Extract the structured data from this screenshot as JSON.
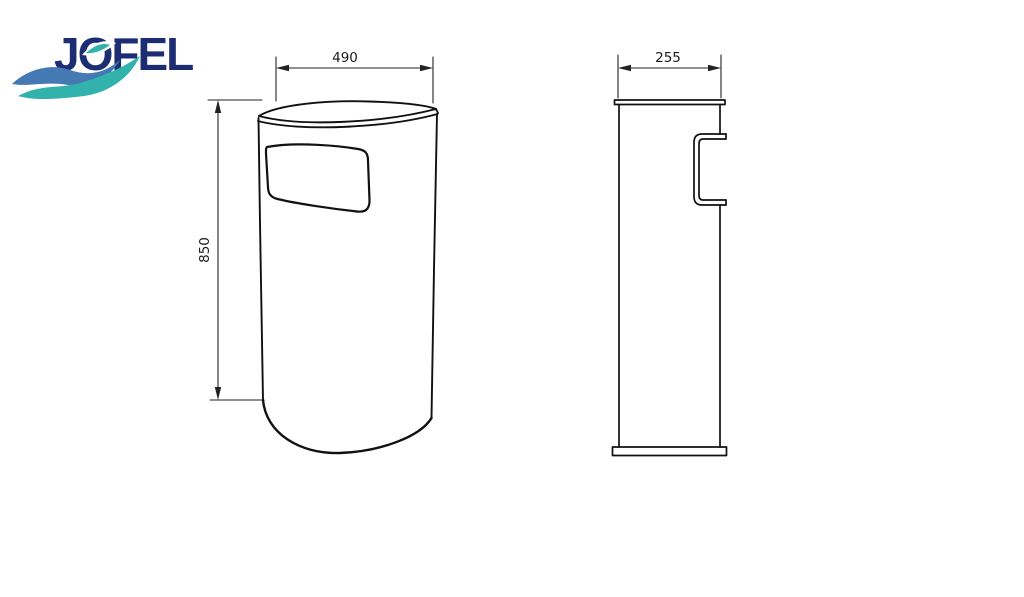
{
  "logo": {
    "brand_name": "JOFEL",
    "text_color": "#1c2d74",
    "wave_blue_color": "#4479b4",
    "wave_teal_color": "#32b2ac"
  },
  "drawing": {
    "background_color": "#ffffff",
    "line_color": "#111111",
    "dimension_line_color": "#222222",
    "front_view": {
      "width": "490",
      "height": "850"
    },
    "side_view": {
      "depth": "255"
    }
  }
}
